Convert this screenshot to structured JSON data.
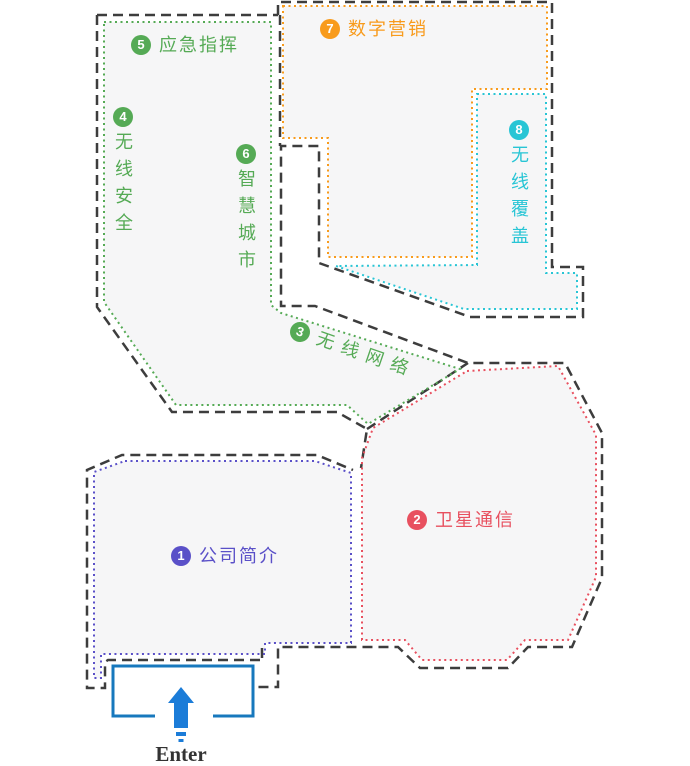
{
  "zones": [
    {
      "num": "1",
      "label": "公司简介",
      "color": "#5a50c8"
    },
    {
      "num": "2",
      "label": "卫星通信",
      "color": "#e8505f"
    },
    {
      "num": "3",
      "label": "无线网络",
      "color": "#55aa55"
    },
    {
      "num": "4",
      "label": "无线安全",
      "color": "#55aa55"
    },
    {
      "num": "5",
      "label": "应急指挥",
      "color": "#55aa55"
    },
    {
      "num": "6",
      "label": "智慧城市",
      "color": "#55aa55"
    },
    {
      "num": "7",
      "label": "数字营销",
      "color": "#f89b1c"
    },
    {
      "num": "8",
      "label": "无线覆盖",
      "color": "#28c5d5"
    }
  ],
  "entrance": {
    "label": "Enter",
    "arrow_color": "#1b7cd8",
    "gate_color": "#1778bd"
  },
  "colors": {
    "wall": "#3d3d3d",
    "region_fill": "#f6f6f7",
    "background": "#ffffff"
  }
}
